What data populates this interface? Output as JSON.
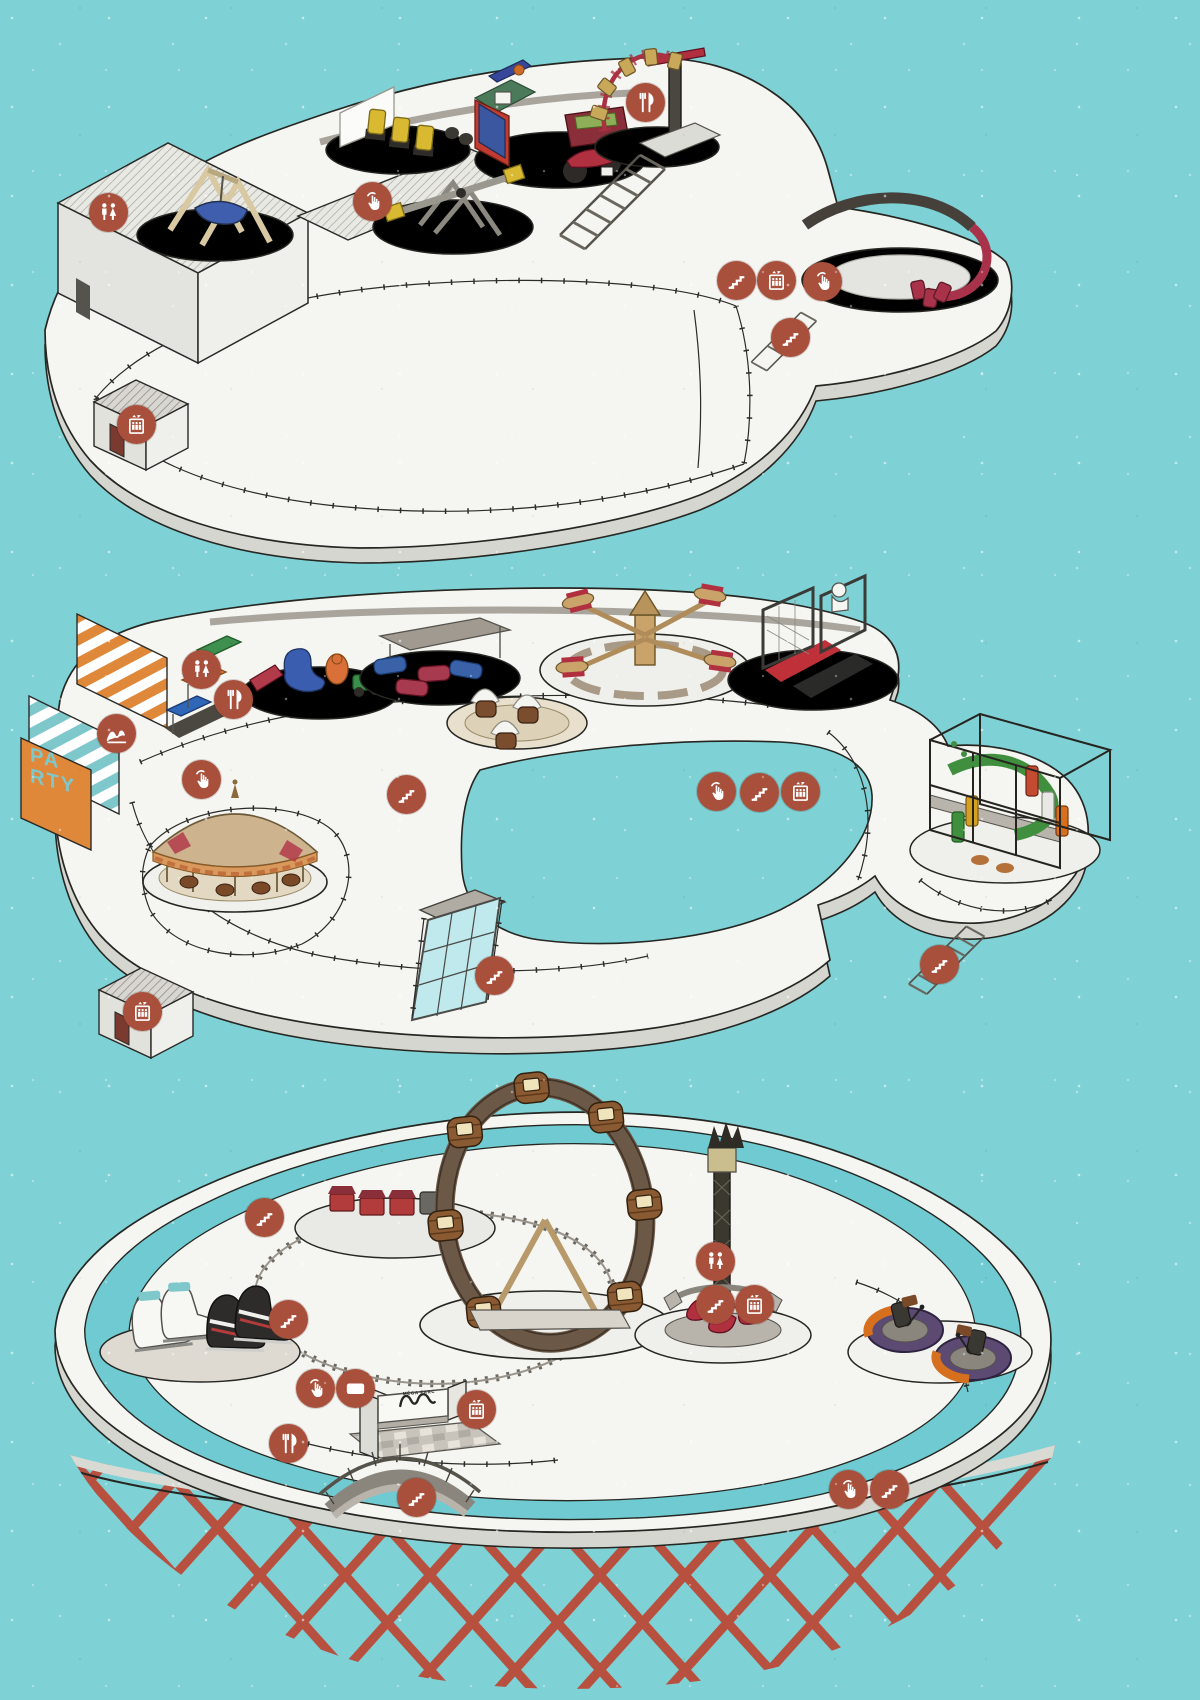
{
  "title": "Mega Parc illustrated park map",
  "palette": {
    "background": "#7ed1d5",
    "island_top": "#f5f5f1",
    "island_side": "#d6d6d0",
    "outline": "#262622",
    "badge": "#a9503c",
    "badge_icon": "#ffffff",
    "water_ring": "#6fcbd1",
    "lattice_red": "#b8503f",
    "party_orange": "#e0883a",
    "party_letters": "#7ec8cc",
    "wood_brown": "#8a5a33",
    "coaster_track": "#6b5847",
    "accent_red": "#a8324a",
    "accent_yellow": "#d9b832"
  },
  "signs": {
    "party_lines": [
      "PA",
      "RTY"
    ],
    "mega_parc": "MÉGA PARC"
  },
  "levels": [
    {
      "id": "upper-level",
      "features": [
        "restroom-building",
        "pendulum-swing-ride",
        "jump-ride",
        "arcade-basketball-game",
        "motorcycle-ride",
        "seesaw-ride",
        "coaster-top-section",
        "spiral-arm-ride",
        "staircases",
        "elevator-kiosk",
        "fenced-walkways"
      ]
    },
    {
      "id": "middle-level",
      "features": [
        "party-sign-wall",
        "canopy-kiddie-ride",
        "kiddie-figures-ride",
        "kids-bumper-cars",
        "barrel-spin-ride",
        "plane-spinner-ride",
        "sports-game-frames",
        "climbing-structure",
        "carousel",
        "glass-walkway",
        "elevator-kiosk",
        "fenced-walkways"
      ]
    },
    {
      "id": "lower-level",
      "features": [
        "water-ring",
        "giant-ice-skates",
        "kiddie-train-ride",
        "loop-coaster",
        "mega-parc-sign",
        "arch-bridge",
        "drop-tower",
        "bumper-cars",
        "red-lattice-bowl"
      ]
    }
  ],
  "markers": [
    {
      "icon": "restrooms",
      "x": 109,
      "y": 213
    },
    {
      "icon": "touch",
      "x": 373,
      "y": 202
    },
    {
      "icon": "food",
      "x": 646,
      "y": 103
    },
    {
      "icon": "stairs",
      "x": 737,
      "y": 281
    },
    {
      "icon": "elevator",
      "x": 777,
      "y": 281
    },
    {
      "icon": "touch",
      "x": 823,
      "y": 282
    },
    {
      "icon": "stairs",
      "x": 791,
      "y": 338
    },
    {
      "icon": "elevator",
      "x": 137,
      "y": 425
    },
    {
      "icon": "restrooms",
      "x": 202,
      "y": 670
    },
    {
      "icon": "coaster",
      "x": 117,
      "y": 734
    },
    {
      "icon": "food",
      "x": 234,
      "y": 700
    },
    {
      "icon": "touch",
      "x": 202,
      "y": 780
    },
    {
      "icon": "stairs",
      "x": 407,
      "y": 795
    },
    {
      "icon": "touch",
      "x": 717,
      "y": 792
    },
    {
      "icon": "stairs",
      "x": 760,
      "y": 793
    },
    {
      "icon": "elevator",
      "x": 801,
      "y": 792
    },
    {
      "icon": "stairs",
      "x": 495,
      "y": 976
    },
    {
      "icon": "stairs",
      "x": 940,
      "y": 965
    },
    {
      "icon": "elevator",
      "x": 143,
      "y": 1012
    },
    {
      "icon": "stairs",
      "x": 265,
      "y": 1218
    },
    {
      "icon": "stairs",
      "x": 289,
      "y": 1320
    },
    {
      "icon": "touch",
      "x": 316,
      "y": 1389
    },
    {
      "icon": "ticket",
      "x": 356,
      "y": 1389
    },
    {
      "icon": "elevator",
      "x": 477,
      "y": 1410
    },
    {
      "icon": "food",
      "x": 289,
      "y": 1444
    },
    {
      "icon": "stairs",
      "x": 417,
      "y": 1498
    },
    {
      "icon": "restrooms",
      "x": 716,
      "y": 1262
    },
    {
      "icon": "stairs",
      "x": 716,
      "y": 1305
    },
    {
      "icon": "elevator",
      "x": 755,
      "y": 1305
    },
    {
      "icon": "touch",
      "x": 849,
      "y": 1490
    },
    {
      "icon": "stairs",
      "x": 890,
      "y": 1490
    }
  ]
}
